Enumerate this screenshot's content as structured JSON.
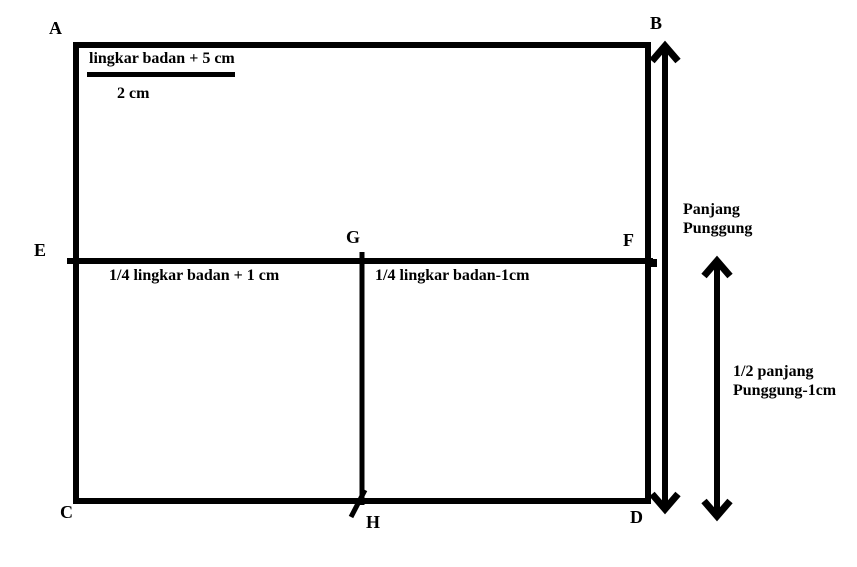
{
  "diagram": {
    "background_color": "#ffffff",
    "line_color": "#000000",
    "points": {
      "a": "A",
      "b": "B",
      "c": "C",
      "d": "D",
      "e": "E",
      "f": "F",
      "g": "G",
      "h": "H"
    },
    "top_fraction": {
      "numerator": "lingkar badan + 5 cm",
      "denominator": "2 cm"
    },
    "labels": {
      "left_section": "1/4 lingkar badan + 1 cm",
      "right_section": "1/4 lingkar badan-1cm",
      "back_length": {
        "line1": "Panjang",
        "line2": "Punggung"
      },
      "half_back_length": {
        "line1": "1/2 panjang",
        "line2": "Punggung-1cm"
      }
    }
  }
}
